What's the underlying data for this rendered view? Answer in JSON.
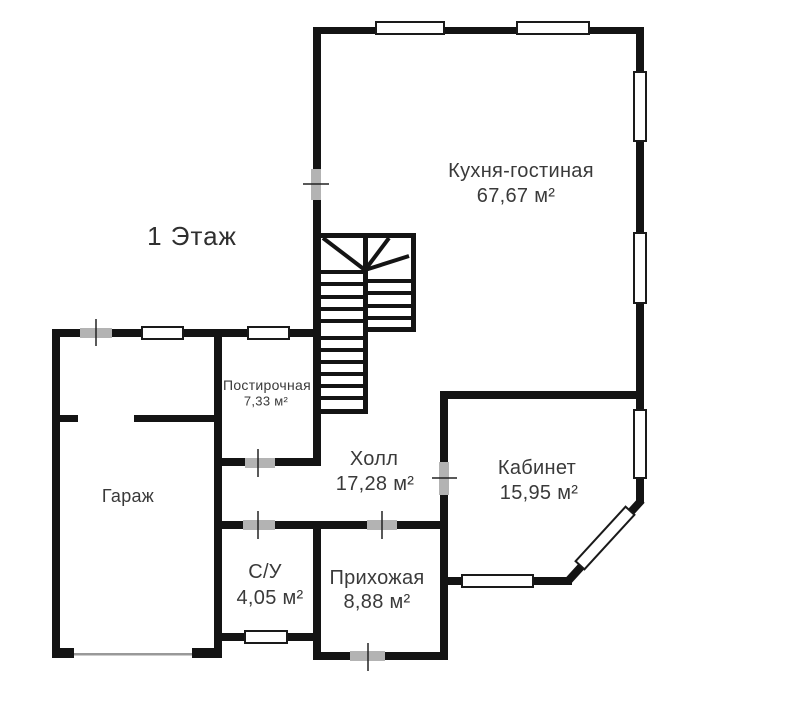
{
  "floor_plan": {
    "title": "1 Этаж",
    "rooms": [
      {
        "id": "kitchen",
        "name": "Кухня-гостиная",
        "area": "67,67 м²"
      },
      {
        "id": "laundry",
        "name": "Постирочная",
        "area": "7,33 м²"
      },
      {
        "id": "garage",
        "name": "Гараж",
        "area": ""
      },
      {
        "id": "hall",
        "name": "Холл",
        "area": "17,28 м²"
      },
      {
        "id": "study",
        "name": "Кабинет",
        "area": "15,95 м²"
      },
      {
        "id": "wc",
        "name": "С/У",
        "area": "4,05 м²"
      },
      {
        "id": "entry",
        "name": "Прихожая",
        "area": "8,88 м²"
      }
    ],
    "colors": {
      "wall": "#141414",
      "window_fill": "#ffffff",
      "door_marker": "#b3b3b3",
      "garage_door_line": "#999999",
      "text": "#3a3a3a"
    }
  }
}
